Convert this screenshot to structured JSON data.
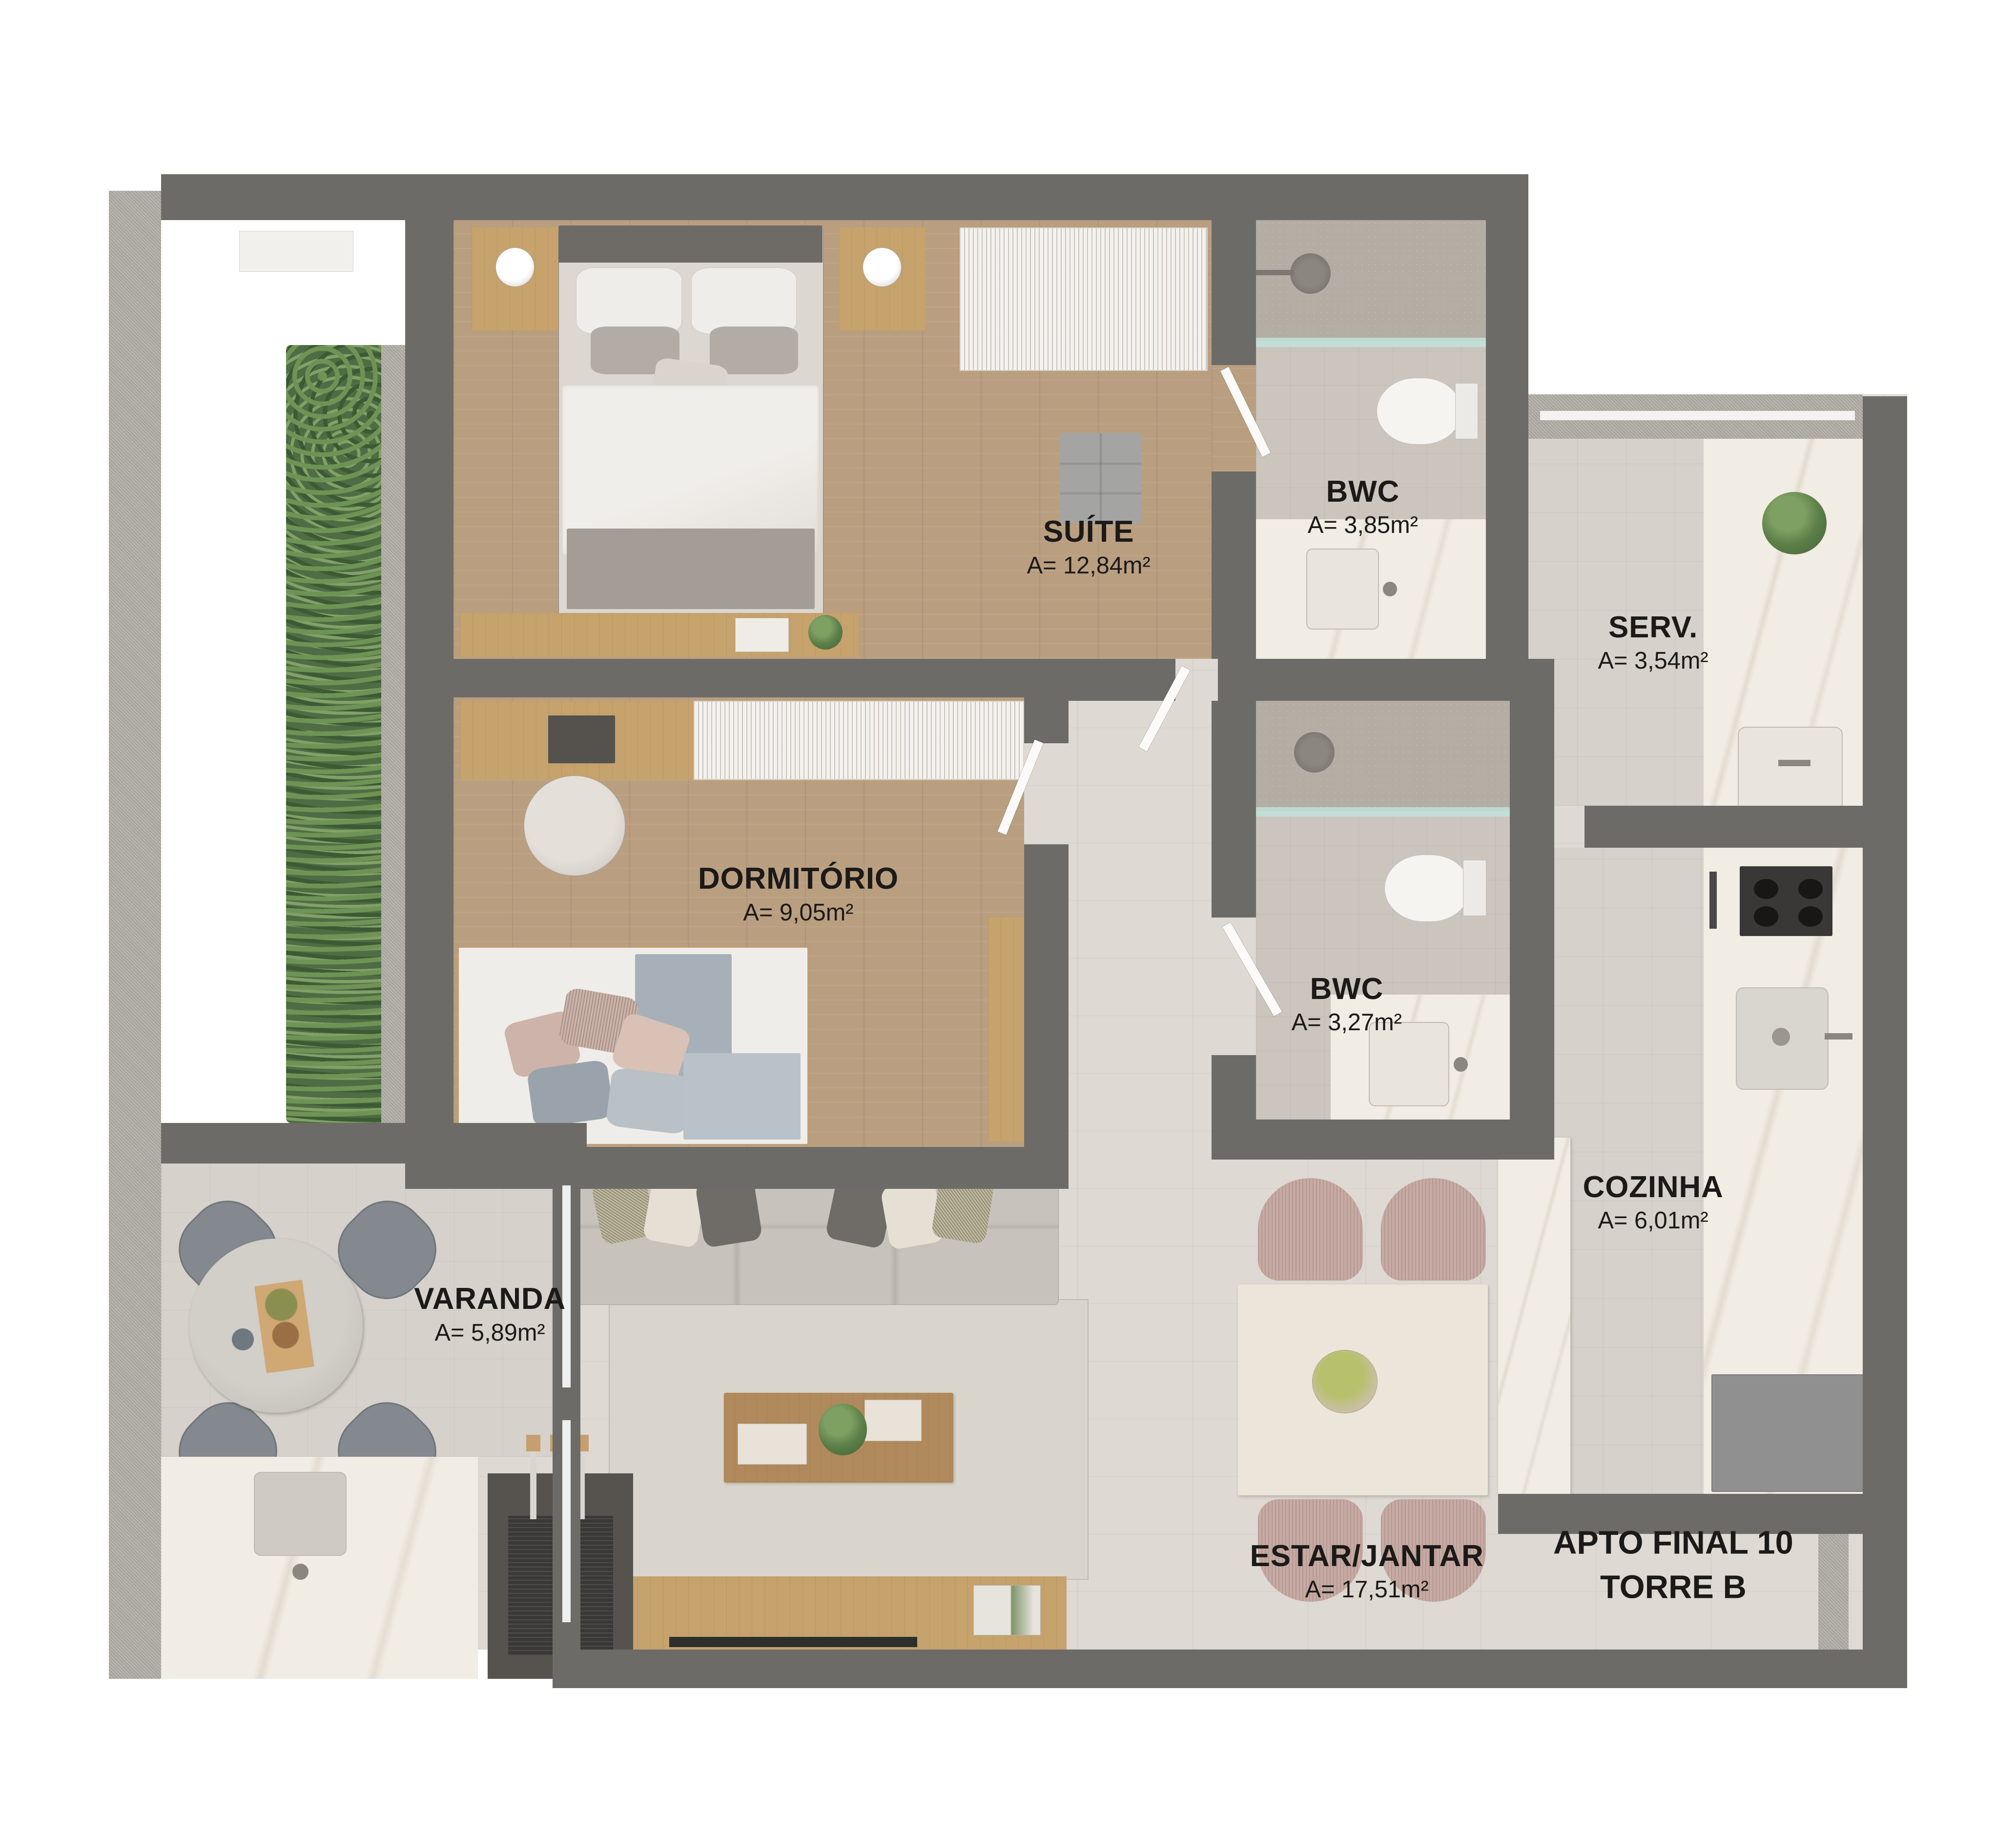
{
  "plan": {
    "type": "residential-floor-plan",
    "unit": {
      "line1": "APTO FINAL 10",
      "line2": "TORRE B"
    }
  },
  "rooms": {
    "suite": {
      "name": "SUÍTE",
      "area": "A= 12,84m²"
    },
    "bwc_suite": {
      "name": "BWC",
      "area": "A= 3,85m²"
    },
    "serv": {
      "name": "SERV.",
      "area": "A= 3,54m²"
    },
    "dormitorio": {
      "name": "DORMITÓRIO",
      "area": "A= 9,05m²"
    },
    "bwc_social": {
      "name": "BWC",
      "area": "A= 3,27m²"
    },
    "cozinha": {
      "name": "COZINHA",
      "area": "A= 6,01m²"
    },
    "varanda": {
      "name": "VARANDA",
      "area": "A= 5,89m²"
    },
    "estar_jantar": {
      "name": "ESTAR/JANTAR",
      "area": "A= 17,51m²"
    }
  },
  "colors": {
    "wall": "#6d6b67",
    "wood_floor": "#b99e80",
    "tile_floor": "#ded9d2",
    "bath_tile": "#ccc5bd",
    "marble": "#f1ece4",
    "plant_green": "#5d8049",
    "label_text": "#1b1a18",
    "background": "#ffffff"
  }
}
